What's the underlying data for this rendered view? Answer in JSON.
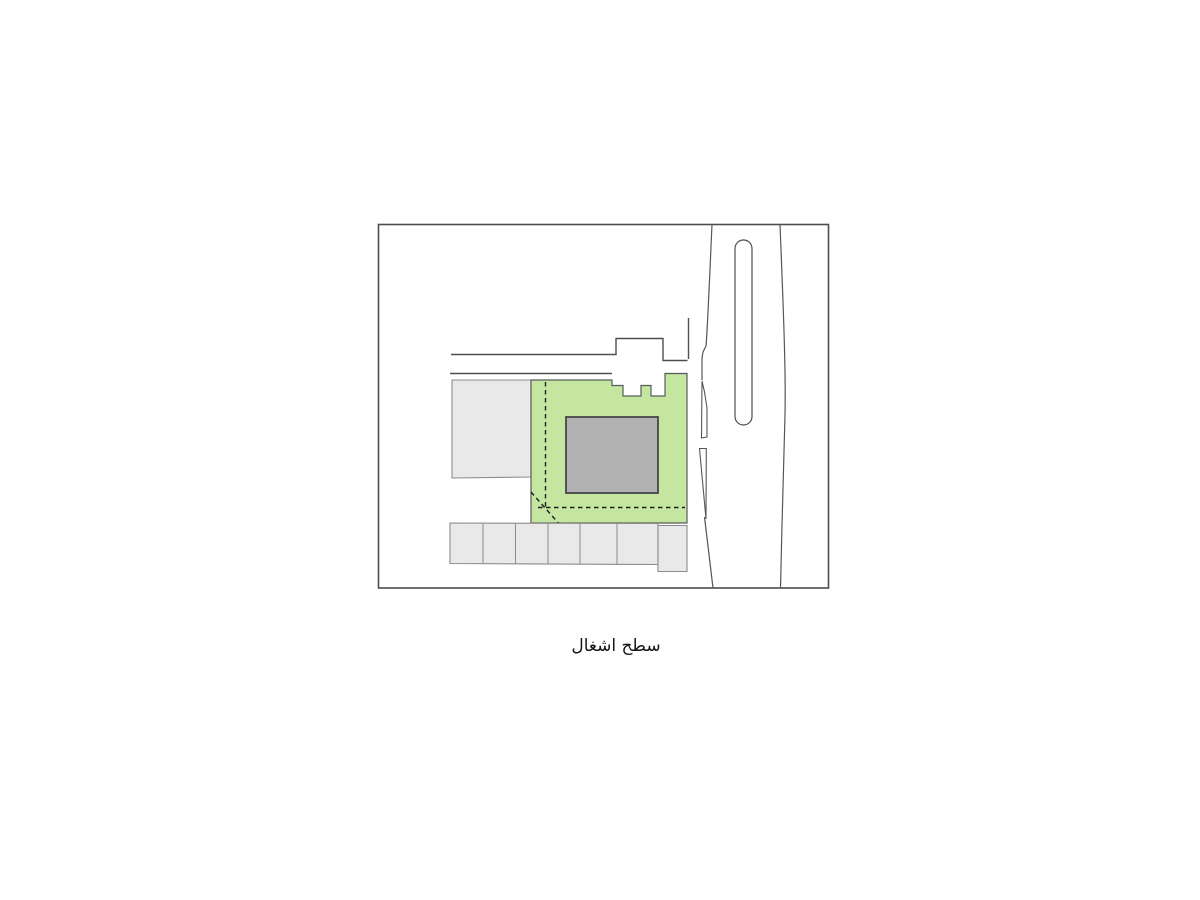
{
  "caption": {
    "text": "سطح اشغال"
  },
  "colors": {
    "occupied_green": "#c5e6a1",
    "building_gray": "#b2b2b2",
    "context_gray": "#e9e9e9",
    "line_dark": "#4d4d4d",
    "background": "#ffffff"
  }
}
